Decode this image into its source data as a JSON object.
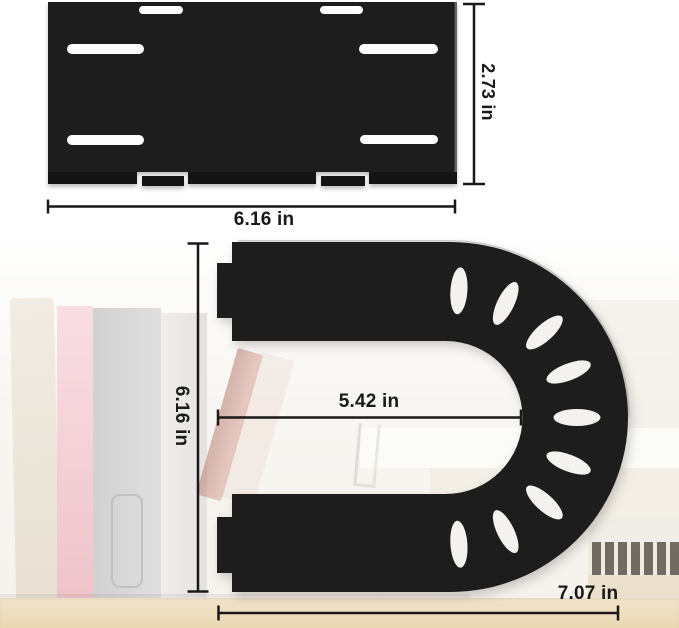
{
  "figure": {
    "type": "product-dimension-diagram",
    "colors": {
      "bracket": "#1d1d1d",
      "bracket_lip": "#141414",
      "dimension_line": "#191919",
      "slot": "#fdfdfd",
      "hole": "#f4f2ee"
    },
    "top_view": {
      "name": "mounting-plate",
      "height_label": "2.73 in",
      "width_label": "6.16 in"
    },
    "side_view": {
      "name": "u-shaped-bracket",
      "height_label": "6.16 in",
      "inner_width_label": "5.42 in",
      "width_label": "7.07 in"
    },
    "holes": {
      "count": 9,
      "angles_deg": [
        86,
        64,
        42,
        21,
        0,
        -21,
        -42,
        -64,
        -86
      ],
      "radius": 127,
      "rx": 23.5,
      "ry": 8.5,
      "center_x": 450,
      "center_y": 417.5
    }
  }
}
